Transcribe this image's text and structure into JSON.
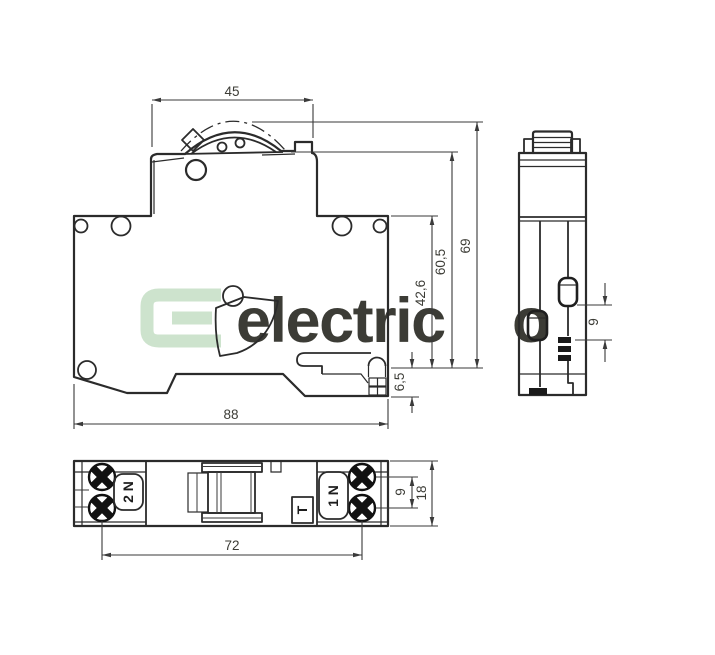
{
  "front_view": {
    "dims": {
      "lever_width": "45",
      "total_height": "69",
      "upper_height": "60,5",
      "body_height": "42,6",
      "rail_clearance": "6,5",
      "total_width": "88"
    }
  },
  "side_view": {
    "dims": {
      "actuator_spacing": "9"
    }
  },
  "bottom_view": {
    "labels": {
      "terminal_left": "2 N",
      "terminal_right": "1 N",
      "test_button": "T"
    },
    "dims": {
      "screw_spacing": "72",
      "screw_pitch": "9",
      "depth": "18"
    }
  },
  "watermark": {
    "logo_letter": "E",
    "name_main": "electric",
    "name_accent": "o"
  },
  "colors": {
    "line": "#2b2b2b",
    "dimension": "#3a3a3a",
    "watermark_logo": "#cde3cd",
    "watermark_text": "#eaf0ea",
    "watermark_accent": "#c6dfc6"
  }
}
